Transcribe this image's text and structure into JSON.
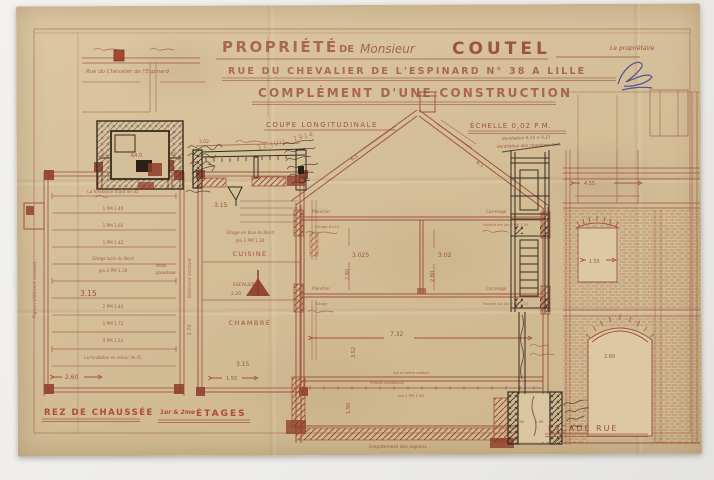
{
  "palette": {
    "scan_background": "#f1f0ed",
    "paper": "#d5bf98",
    "ink_sepia": "#9e5340",
    "ink_title": "#b34731",
    "ink_owner_name": "#7e2a18",
    "ink_black": "#352b20",
    "ink_blue": "#3c3f96",
    "ink_stamp": "#9c50ae"
  },
  "title_block": {
    "property": "PROPRIÉTÉ",
    "de": "DE",
    "monsieur": "Monsieur",
    "owner_name": "COUTEL",
    "address": "RUE DU CHEVALIER DE L'ESPINARD N° 38 A LILLE",
    "subtitle": "COMPLÉMENT D'UNE CONSTRUCTION",
    "owner_note": "Le propriétaire"
  },
  "stamp": {
    "date": "11 JUIL. 1914"
  },
  "site_plan": {
    "street": "Rue du Chevalier de l'Espinard"
  },
  "chimney_detail": {
    "dim_left": ".45",
    "dim_mid": "64.0",
    "dim_right": ".45"
  },
  "beam_detail": {
    "dim": "3.02"
  },
  "ground_plan": {
    "caption": "REZ DE CHAUSSÉE",
    "top_note": "La fondation filant de 45",
    "joists": [
      "1 PM 1.40",
      "1 PM 1.60",
      "1 PM 1.42",
      "2 PM 1.40",
      "1 PM 1.72",
      "4 PM 1.52"
    ],
    "gitage_note": "Gitage bois du Nord",
    "jon_note": "Jon 2 PM 1.30",
    "width_dim": "3.15",
    "bottom_note": "La fondation en retour de 45",
    "bottom_dim": "2.60",
    "left_margin_note": "Pignon bâtiment existant",
    "right_margin_note": "Bâtiment existant",
    "right_margin_dim": "3.70",
    "door_note_1": "Porte",
    "door_note_2": "pareclose"
  },
  "upper_plan": {
    "caption_prefix": "1er & 2me",
    "caption": "ÉTAGES",
    "top_dim": "3.15",
    "gitage_note": "Gitage en bois du Nord",
    "jon_note": "Jon 2 PM 1.30",
    "kitchen": "CUISINE",
    "stair": "ESCALIER",
    "stair_dim": "2.20",
    "bedroom": "CHAMBRE",
    "bottom_dim": "3.15",
    "bottom_dim_2": "1.55"
  },
  "section": {
    "caption": "COUPE LONGITUDINALE",
    "scale_note": "ÉCHELLE 0,02 P.M.",
    "vent_note_1": "Ventilation 0,15 × 0,15",
    "vent_note_2": "Ventilation des chambres 0,15",
    "floor_label_1": "Plancher",
    "floor_label_2": "Plancher",
    "gitage_label_1": "Gitage 8×23",
    "gitage_label_2": "Gitage",
    "tile_label_1": "Carrelage",
    "tile_label_2": "Carrelage",
    "hourdis_note_1": "Hourdis sur Jon 2 PM 1.30",
    "hourdis_note_2": "Hourdis sur Jon 2 PM 1.30",
    "soil_note": "Sol en terre battue",
    "foundation_note": "Petites fondations",
    "cellar_joist_note": "Jon 2 PM 1.40",
    "footing_note": "Empatement des pignons",
    "dims": {
      "roof_left": "6.1",
      "roof_right": "6.1",
      "bay_left": "3.025",
      "bay_right": "3.02",
      "height_left": "2.80",
      "height_right": "2.80",
      "room_width": "7.32",
      "room_height": "3.52",
      "cellar_height": "1.90"
    }
  },
  "pit_detail": {
    "dim_1": ".90",
    "dim_2": "2.45",
    "side_dim": "2.215"
  },
  "facade": {
    "caption": "FAÇADE RUE",
    "upper_dim": "4.55",
    "window_dim": "1.55",
    "arch_dim": "2.60"
  }
}
